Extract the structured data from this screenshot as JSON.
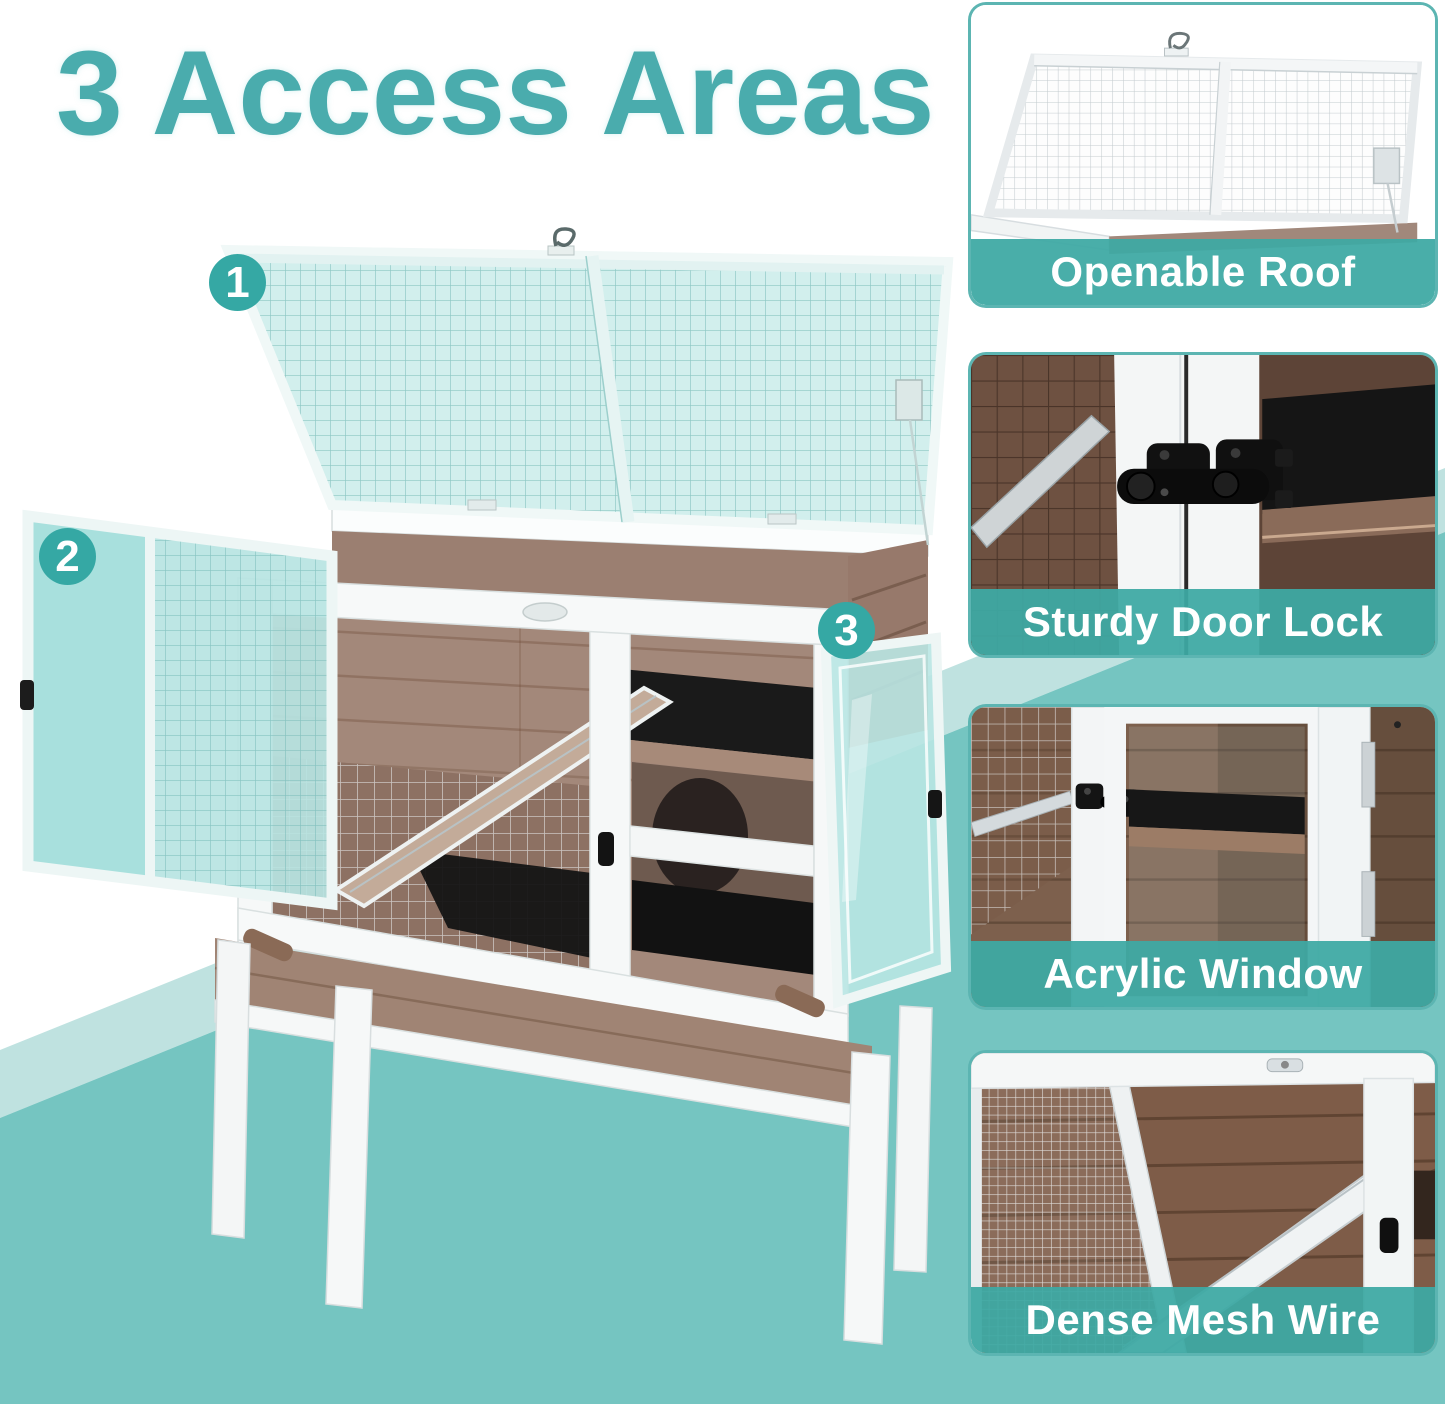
{
  "header": {
    "title": "3 Access Areas"
  },
  "callouts": {
    "items": [
      {
        "number": "1"
      },
      {
        "number": "2"
      },
      {
        "number": "3"
      }
    ]
  },
  "sidebar": {
    "cards": [
      {
        "caption": "Openable Roof"
      },
      {
        "caption": "Sturdy Door Lock"
      },
      {
        "caption": "Acrylic Window"
      },
      {
        "caption": "Dense Mesh Wire"
      }
    ]
  },
  "colors": {
    "accent_teal": "#3fa8a4",
    "title_teal": "#4aacad",
    "badge_teal": "#35a8a4",
    "background_teal": "#75c5c1",
    "light_band_teal": "#bfe2e0",
    "acrylic_tint": "#b9e5e3",
    "wood_brown": "#9b7f71",
    "caption_text": "#ffffff"
  }
}
